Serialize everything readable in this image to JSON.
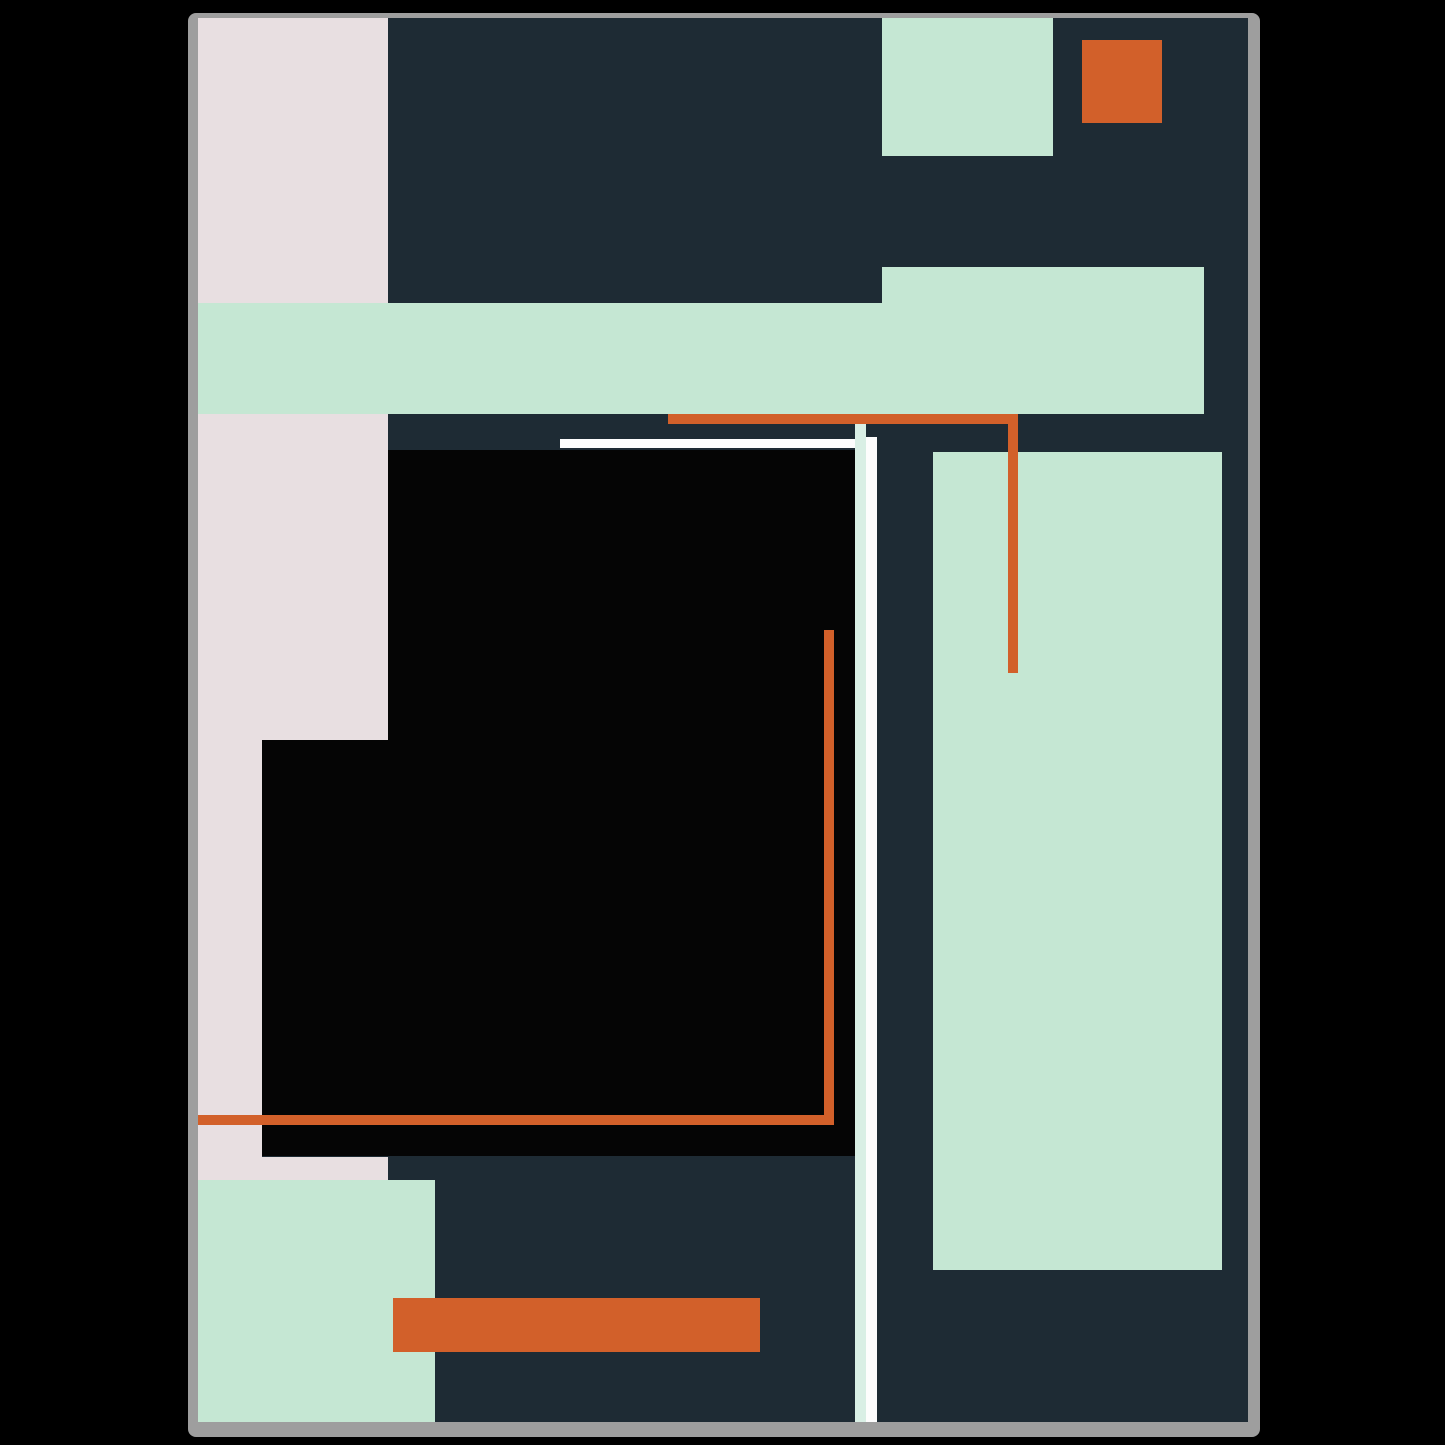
{
  "artwork": {
    "description": "abstract-geometric-poster",
    "palette": {
      "background": "#000000",
      "frame_gray": "#9e9e9e",
      "navy": "#1e2b34",
      "mint": "#c5e7d3",
      "mint_light": "#d9efe5",
      "pink": "#e8dfe1",
      "orange": "#d2602a",
      "black": "#050505",
      "white": "#fdfdfd"
    },
    "frame": {
      "x": 188,
      "y": 13,
      "w": 1072,
      "h": 1424
    },
    "content": {
      "x": 198,
      "y": 18,
      "w": 1050,
      "h": 1404,
      "fill": "navy"
    },
    "shapes": [
      {
        "name": "pink-column-top",
        "fill": "pink",
        "x": 0,
        "y": 0,
        "w": 190,
        "h": 285
      },
      {
        "name": "top-mint-rect",
        "fill": "mint",
        "x": 684,
        "y": 0,
        "w": 171,
        "h": 138
      },
      {
        "name": "top-orange-square",
        "fill": "orange",
        "x": 884,
        "y": 22,
        "w": 80,
        "h": 83
      },
      {
        "name": "mint-band-right-step",
        "fill": "mint",
        "x": 684,
        "y": 249,
        "w": 322,
        "h": 36
      },
      {
        "name": "mint-band-main",
        "fill": "mint",
        "x": 0,
        "y": 285,
        "w": 1006,
        "h": 111
      },
      {
        "name": "pink-column-middle",
        "fill": "pink",
        "x": 0,
        "y": 396,
        "w": 190,
        "h": 326
      },
      {
        "name": "pink-column-narrow",
        "fill": "pink",
        "x": 0,
        "y": 722,
        "w": 64,
        "h": 417
      },
      {
        "name": "pink-strip-bottom",
        "fill": "pink",
        "x": 0,
        "y": 1139,
        "w": 190,
        "h": 23
      },
      {
        "name": "black-square-upper",
        "fill": "black",
        "x": 190,
        "y": 432,
        "w": 467,
        "h": 290
      },
      {
        "name": "black-square-lower",
        "fill": "black",
        "x": 64,
        "y": 722,
        "w": 593,
        "h": 416
      },
      {
        "name": "right-mint-rect",
        "fill": "mint",
        "x": 735,
        "y": 434,
        "w": 289,
        "h": 818
      },
      {
        "name": "white-horizontal-line",
        "fill": "white",
        "x": 362,
        "y": 421,
        "w": 317,
        "h": 9
      },
      {
        "name": "white-vertical-line",
        "fill": "white",
        "x": 668,
        "y": 419,
        "w": 11,
        "h": 985
      },
      {
        "name": "mint-vertical-strip",
        "fill": "mint_light",
        "x": 657,
        "y": 406,
        "w": 11,
        "h": 998
      },
      {
        "name": "orange-top-line",
        "fill": "orange",
        "x": 470,
        "y": 396,
        "w": 350,
        "h": 10
      },
      {
        "name": "orange-right-drop-line",
        "fill": "orange",
        "x": 810,
        "y": 396,
        "w": 10,
        "h": 259
      },
      {
        "name": "orange-corner-vertical",
        "fill": "orange",
        "x": 626,
        "y": 612,
        "w": 10,
        "h": 495
      },
      {
        "name": "orange-corner-horizontal",
        "fill": "orange",
        "x": 0,
        "y": 1097,
        "w": 636,
        "h": 10
      },
      {
        "name": "bottom-mint-block",
        "fill": "mint",
        "x": 0,
        "y": 1162,
        "w": 237,
        "h": 242
      },
      {
        "name": "bottom-orange-bar",
        "fill": "orange",
        "x": 195,
        "y": 1280,
        "w": 367,
        "h": 54
      }
    ]
  }
}
